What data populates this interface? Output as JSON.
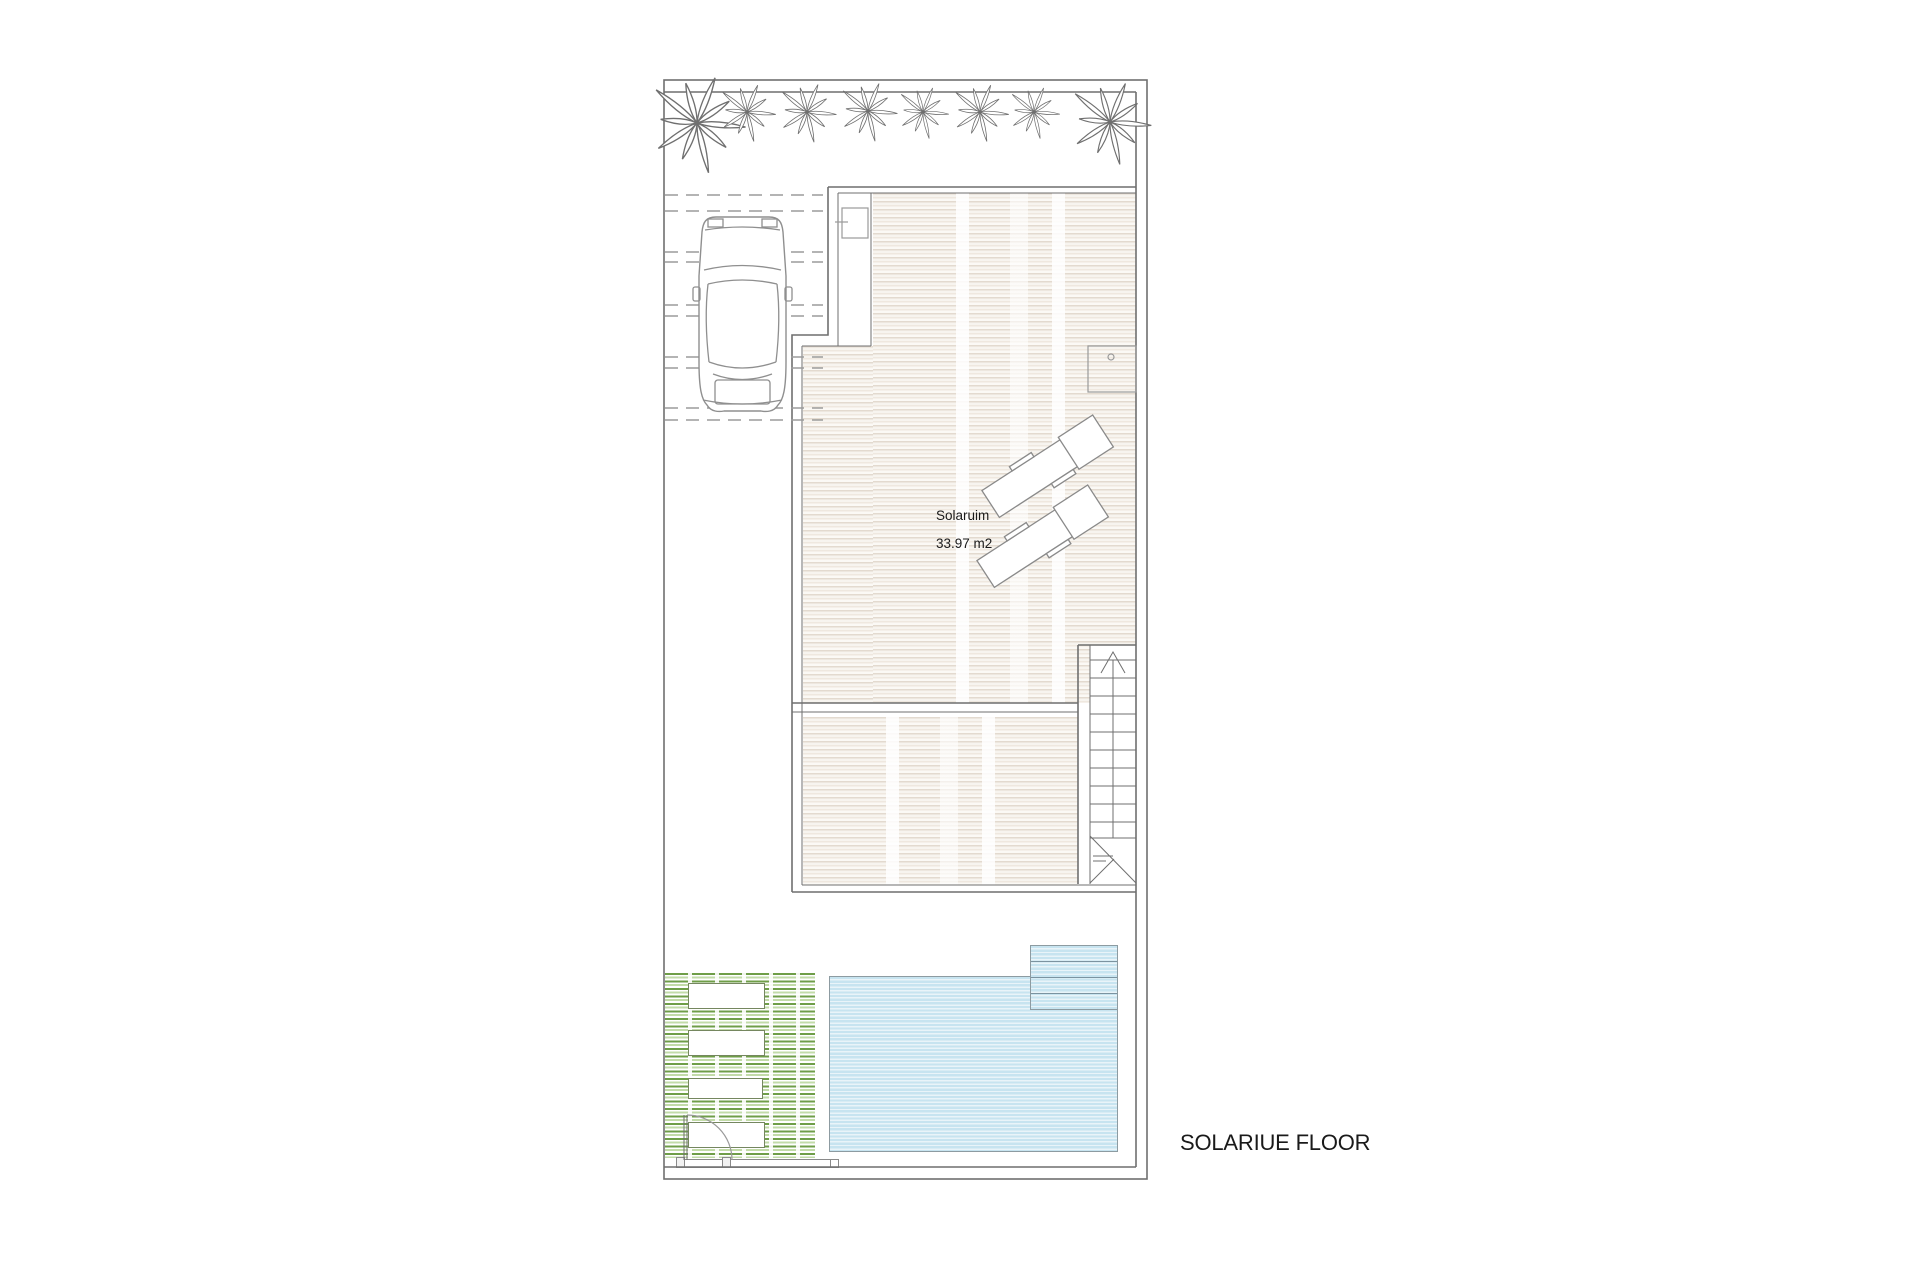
{
  "floor_plan": {
    "title": "SOLARIUE FLOOR",
    "room": {
      "name": "Solaruim",
      "area": "33.97 m2"
    },
    "counts": {
      "palm_trees": 8,
      "sun_loungers": 2,
      "planters": 4,
      "pool_steps": 4,
      "stair_treads": 11
    },
    "icons": {
      "palm": "palm-tree-icon",
      "car": "car-top-view-icon",
      "lounger": "sun-lounger-icon",
      "stairs": "staircase-icon",
      "gate": "gate-swing-icon",
      "shower": "outdoor-shower-icon"
    }
  },
  "colors": {
    "wall": "#6f6f6f",
    "line-light": "#9c9c9c",
    "deck-stripe": "#e3dacf",
    "deck-bg": "#f7f4ef",
    "pool-fill": "#c7e4f0",
    "pool-stripe": "#e9f4f9",
    "pool-border": "#8d9ba1",
    "pool-step-line": "#7b93a0",
    "grass-dark": "#6f9e48",
    "grass-light": "#c2dba8",
    "text": "#1a1a1a"
  }
}
